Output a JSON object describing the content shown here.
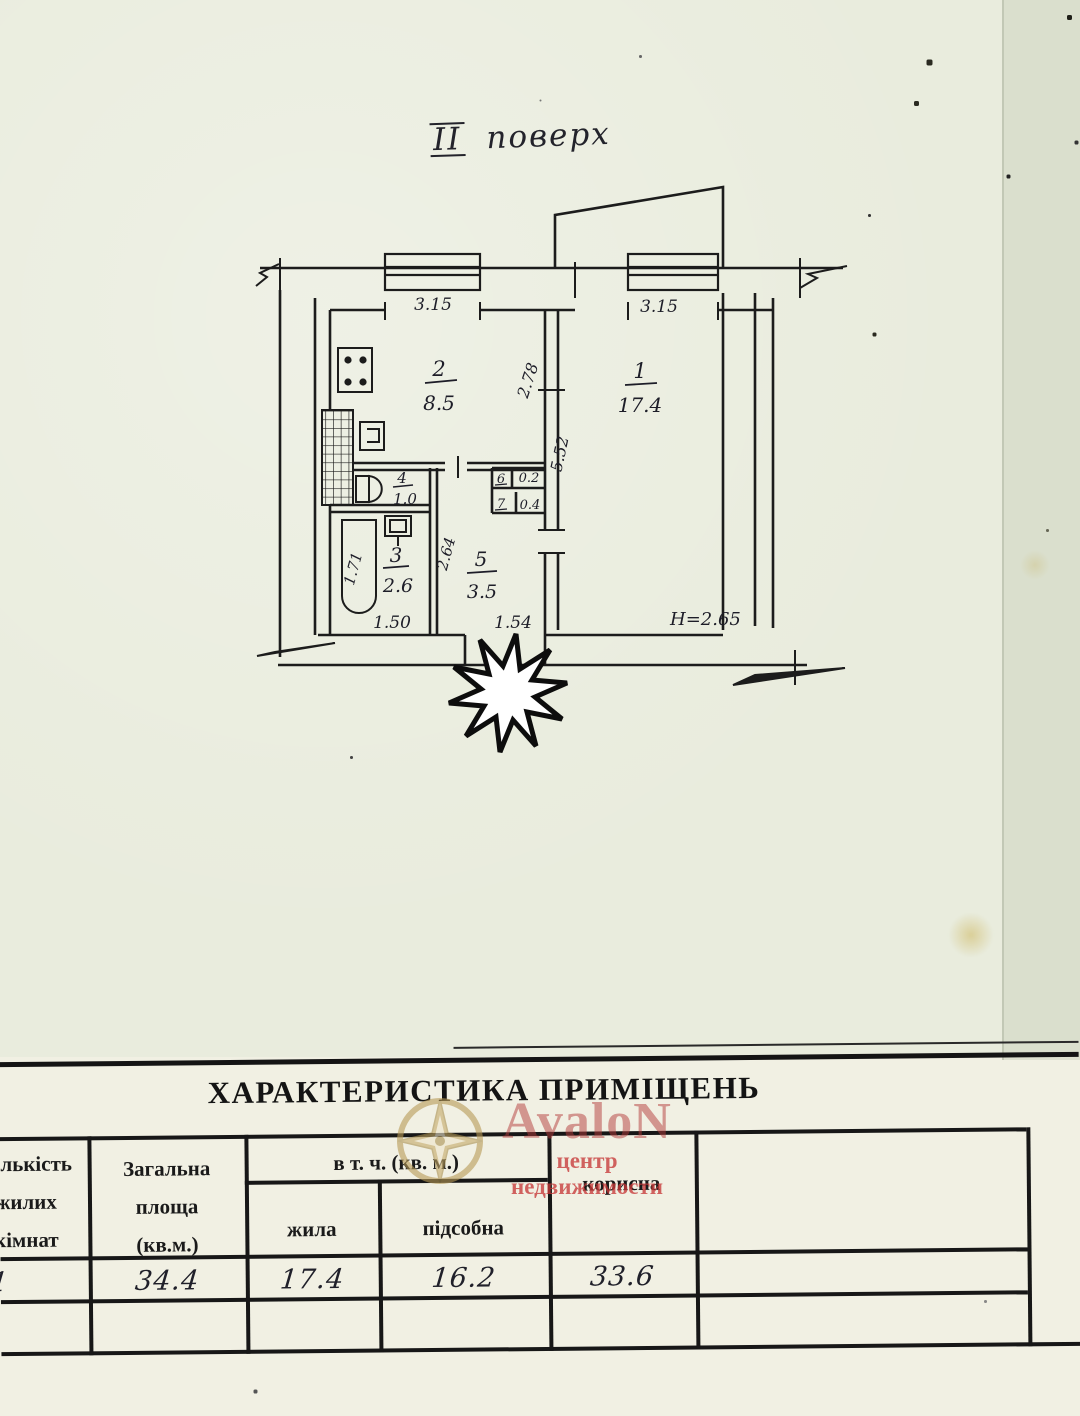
{
  "document": {
    "floor_title": {
      "roman": "ІІ",
      "text": "поверх"
    },
    "plan": {
      "rooms": {
        "room1": {
          "number": "1",
          "area": "17.4"
        },
        "room2": {
          "number": "2",
          "area": "8.5"
        },
        "room3": {
          "number": "3",
          "area": "2.6"
        },
        "room4": {
          "number": "4",
          "area": "1.0"
        },
        "room5": {
          "number": "5",
          "area": "3.5"
        },
        "room6": {
          "number": "6",
          "area": "0.2"
        },
        "room7": {
          "number": "7",
          "area": "0.4"
        }
      },
      "dimensions": {
        "top_left_width": "3.15",
        "top_right_width": "3.15",
        "kitchen_depth": "2.78",
        "room1_depth": "5.52",
        "hall_depth": "2.64",
        "tub_length": "1.71",
        "bath_width": "1.50",
        "hall_width": "1.54",
        "ceiling_height": "H=2.65"
      }
    },
    "table": {
      "title": "ХАРАКТЕРИСТИКА ПРИМІЩЕНЬ",
      "headers": {
        "rooms_count": [
          "Кількість",
          "жилих",
          "кімнат"
        ],
        "total_area": [
          "Загальна",
          "площа",
          "(кв.м.)"
        ],
        "including": "в т. ч. (кв. м.)",
        "living": "жила",
        "auxiliary": "підсобна",
        "useful": "корисна"
      },
      "values": {
        "rooms_count": "1",
        "total_area": "34.4",
        "living_area": "17.4",
        "auxiliary_area": "16.2",
        "useful_area": "33.6"
      }
    },
    "watermark": {
      "brand": "AvaloN",
      "subtitle": "центр недвижимости"
    }
  }
}
